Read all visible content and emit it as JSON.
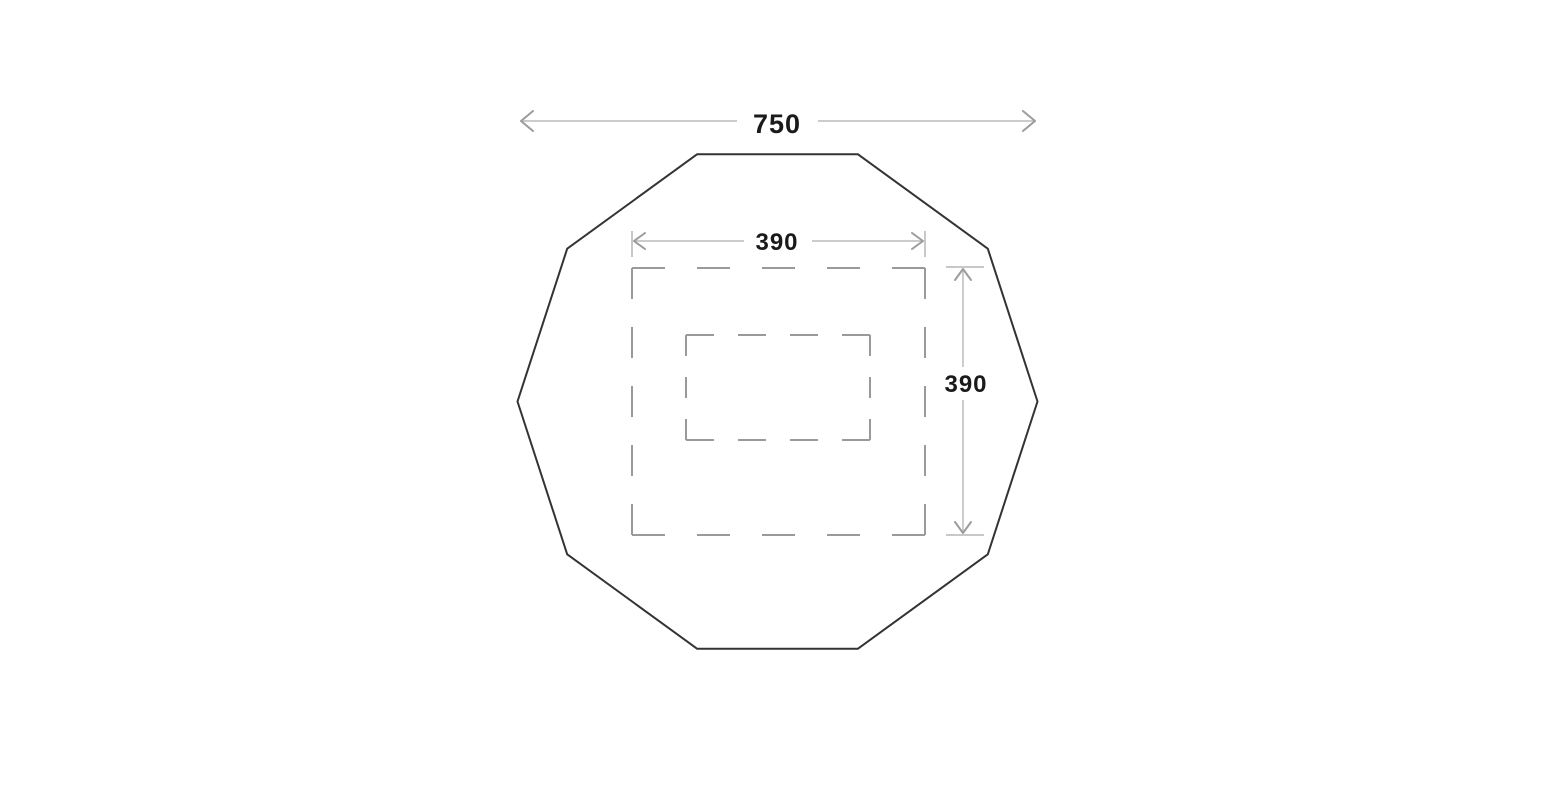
{
  "dimensions": {
    "overall_width": {
      "label": "750",
      "orientation": "horizontal"
    },
    "inner_width": {
      "label": "390",
      "orientation": "horizontal"
    },
    "inner_height": {
      "label": "390",
      "orientation": "vertical"
    }
  },
  "shapes": {
    "outline_sides": 10,
    "dashed_regions": 2
  },
  "colors": {
    "outline": "#333333",
    "dashed_line": "#9a9a9a",
    "dimension_line": "#bcbcbc",
    "label_text": "#1a1a1a",
    "background": "#ffffff"
  }
}
